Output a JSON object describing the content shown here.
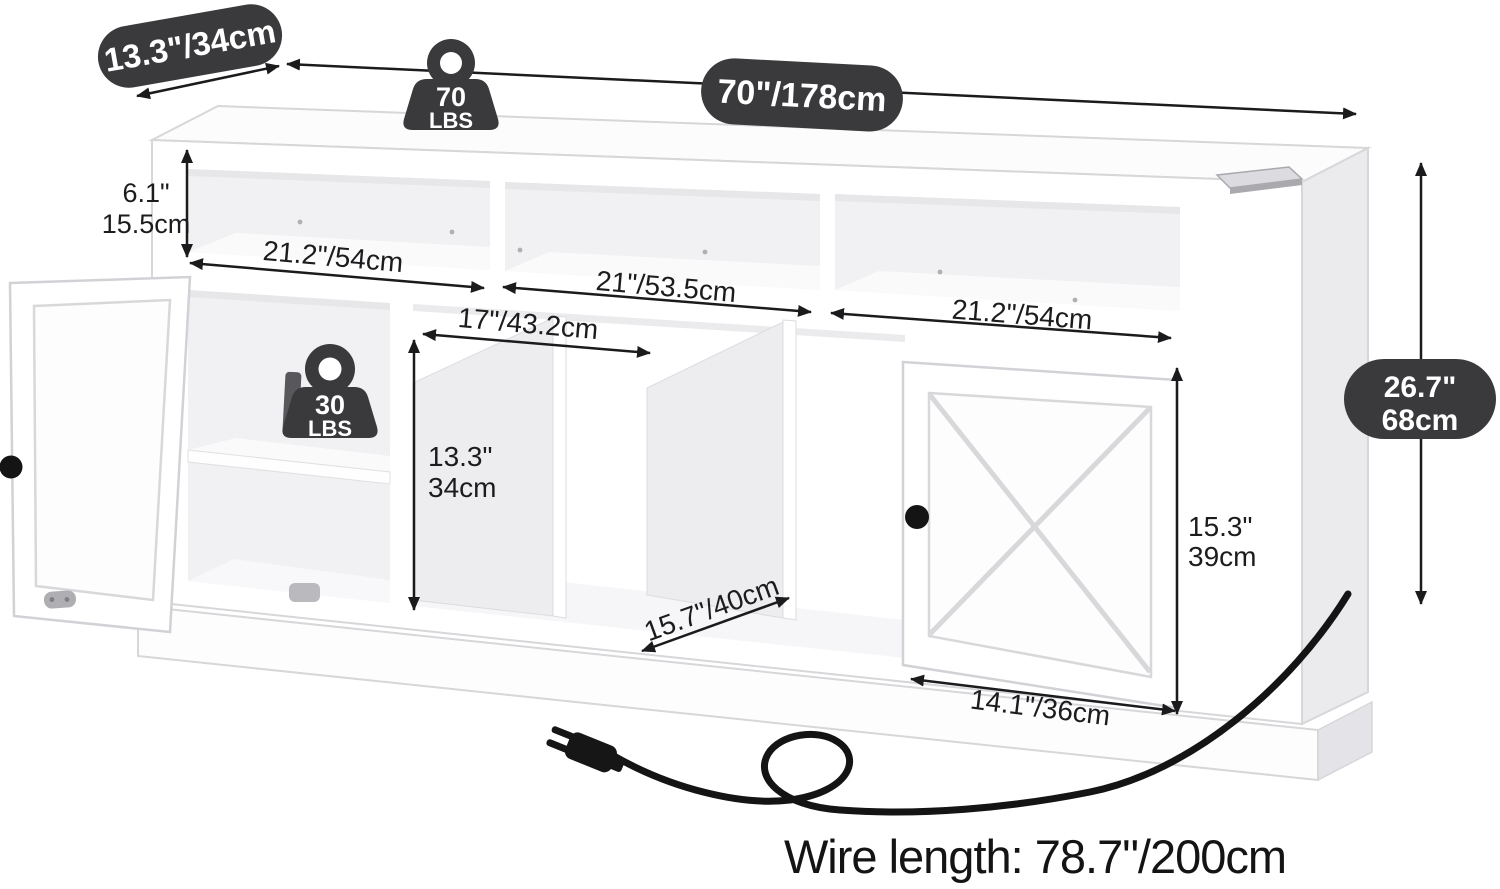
{
  "title": "TV stand dimension diagram",
  "colors": {
    "badge_bg": "#3a3a3c",
    "dark": "#3a3a3c",
    "arrow": "#1b1b1d",
    "cord": "#141414",
    "interior": "#f1f1f3",
    "panel_side": "#ededf0"
  },
  "badges": {
    "depth": "13.3\"/34cm",
    "width": "70\"/178cm",
    "height": [
      "26.7\"",
      "68cm"
    ]
  },
  "weights": {
    "top": [
      "70",
      "LBS"
    ],
    "shelf": [
      "30",
      "LBS"
    ]
  },
  "dims": {
    "cubby_height": [
      "6.1\"",
      "15.5cm"
    ],
    "cubby_left": "21.2\"/54cm",
    "cubby_middle": "21\"/53.5cm",
    "cubby_right": "21.2\"/54cm",
    "media_width": "17\"/43.2cm",
    "media_height": [
      "13.3\"",
      "34cm"
    ],
    "media_depth": "15.7\"/40cm",
    "door_height": [
      "15.3\"",
      "39cm"
    ],
    "door_width": "14.1\"/36cm"
  },
  "footer": {
    "wire_length": "Wire length: 78.7\"/200cm"
  }
}
